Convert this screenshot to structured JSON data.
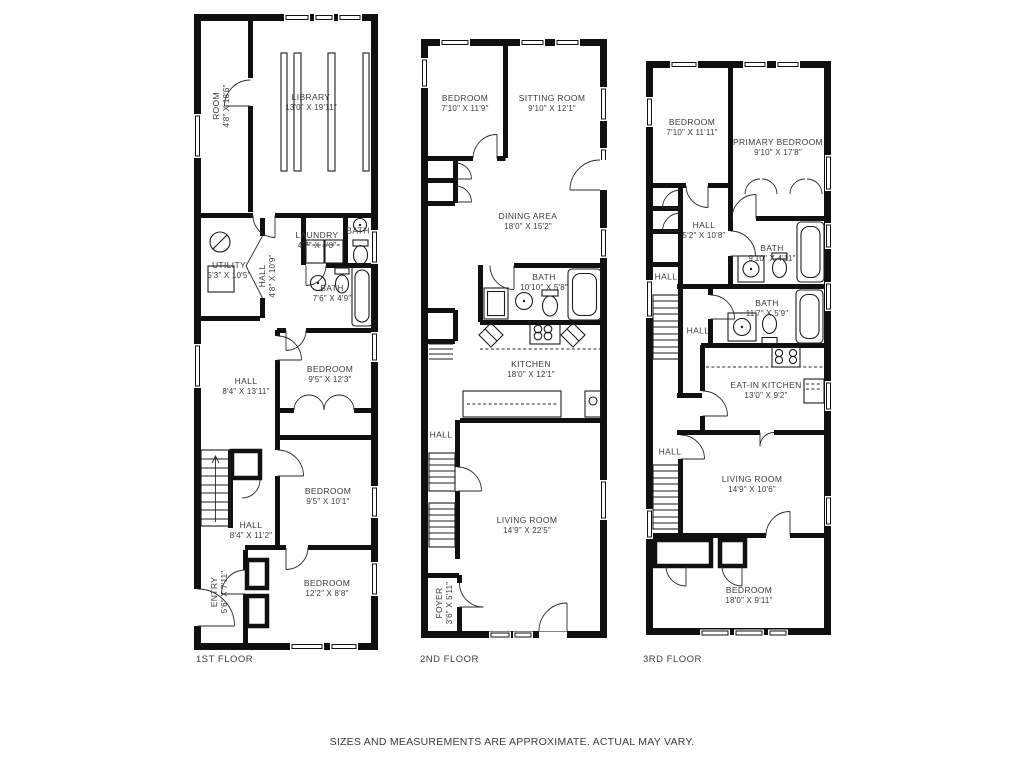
{
  "colors": {
    "walls": "#101010",
    "text": "#3a3a3a",
    "background": "#ffffff"
  },
  "disclaimer": "SIZES AND MEASUREMENTS ARE APPROXIMATE. ACTUAL MAY VARY.",
  "floors": [
    {
      "name": "1ST FLOOR",
      "rooms": [
        {
          "label": "ROOM",
          "dims": "4'8\" X 18'6\""
        },
        {
          "label": "LIBRARY",
          "dims": "13'0\" X 19'11\""
        },
        {
          "label": "UTILITY",
          "dims": "5'3\" X 10'5\""
        },
        {
          "label": "LAUNDRY",
          "dims": "4'7\" X 4'8\""
        },
        {
          "label": "BATH",
          "dims": ""
        },
        {
          "label": "HALL",
          "dims": "4'8\" X 10'9\""
        },
        {
          "label": "BATH",
          "dims": "7'6\" X 4'9\""
        },
        {
          "label": "HALL",
          "dims": "8'4\" X 13'11\""
        },
        {
          "label": "BEDROOM",
          "dims": "9'5\" X 12'3\""
        },
        {
          "label": "BEDROOM",
          "dims": "9'5\" X 10'1\""
        },
        {
          "label": "HALL",
          "dims": "8'4\" X 11'2\""
        },
        {
          "label": "ENTRY",
          "dims": "5'6\" X 7'11\""
        },
        {
          "label": "BEDROOM",
          "dims": "12'2\" X 8'8\""
        }
      ]
    },
    {
      "name": "2ND FLOOR",
      "rooms": [
        {
          "label": "BEDROOM",
          "dims": "7'10\" X 11'9\""
        },
        {
          "label": "SITTING ROOM",
          "dims": "9'10\" X 12'1\""
        },
        {
          "label": "DINING AREA",
          "dims": "18'0\" X 15'2\""
        },
        {
          "label": "BATH",
          "dims": "10'10\" X 5'8\""
        },
        {
          "label": "KITCHEN",
          "dims": "18'0\" X 12'1\""
        },
        {
          "label": "HALL",
          "dims": ""
        },
        {
          "label": "LIVING ROOM",
          "dims": "14'9\" X 22'5\""
        },
        {
          "label": "FOYER",
          "dims": "3'6\" X 5'11\""
        }
      ]
    },
    {
      "name": "3RD FLOOR",
      "rooms": [
        {
          "label": "BEDROOM",
          "dims": "7'10\" X 11'11\""
        },
        {
          "label": "PRIMARY BEDROOM",
          "dims": "9'10\" X 17'8\""
        },
        {
          "label": "HALL",
          "dims": "5'2\" X 10'8\""
        },
        {
          "label": "BATH",
          "dims": "9'10\" X 4'11\""
        },
        {
          "label": "HALL",
          "dims": ""
        },
        {
          "label": "BATH",
          "dims": "11'7\" X 5'9\""
        },
        {
          "label": "HALL",
          "dims": ""
        },
        {
          "label": "EAT-IN KITCHEN",
          "dims": "13'0\" X 9'2\""
        },
        {
          "label": "HALL",
          "dims": ""
        },
        {
          "label": "LIVING ROOM",
          "dims": "14'9\" X 10'6\""
        },
        {
          "label": "BEDROOM",
          "dims": "18'0\" X 9'11\""
        }
      ]
    }
  ]
}
